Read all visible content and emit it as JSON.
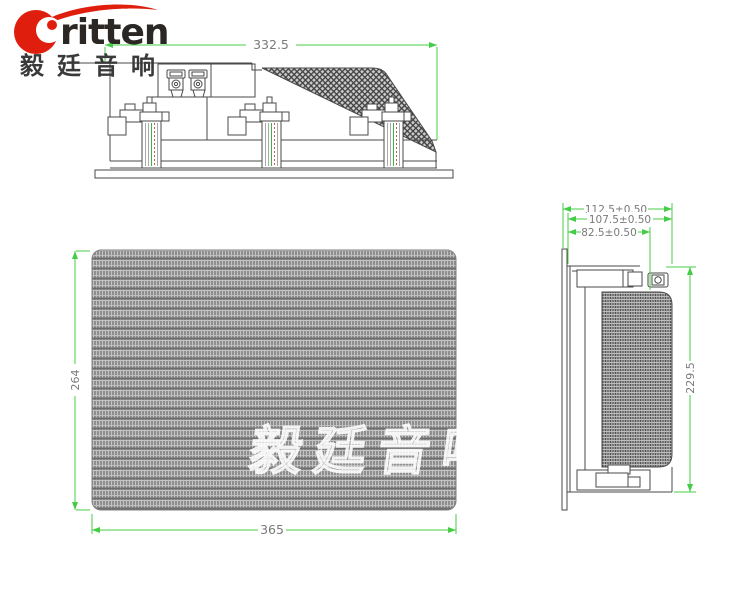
{
  "logo": {
    "brand": "ritten",
    "brand_cn": "毅廷音响"
  },
  "watermark": "毅廷音响",
  "colors": {
    "dimension_line": "#44cc44",
    "dimension_text": "#7a7a7a",
    "drawing_line": "#4a4a4a",
    "logo_red": "#e01e0e",
    "logo_text": "#2b2724"
  },
  "views": {
    "top_view": {
      "width_dim": "332.5"
    },
    "front_view": {
      "width_dim": "365",
      "height_dim": "264"
    },
    "side_view": {
      "depth_overall_dim": "112.5±0.50",
      "depth_mid_dim": "107.5±0.50",
      "depth_inner_dim": "82.5±0.50",
      "height_dim": "229.5"
    }
  }
}
